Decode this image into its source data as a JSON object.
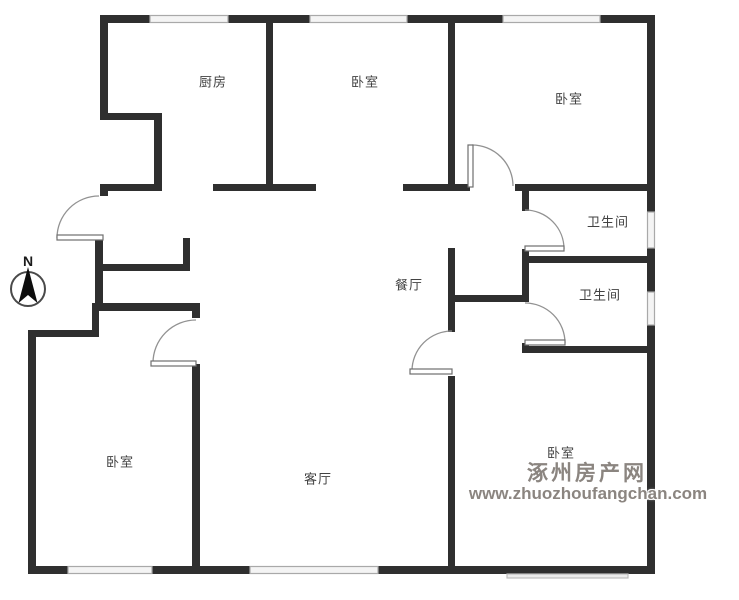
{
  "floorplan": {
    "rooms": [
      {
        "label": "厨房"
      },
      {
        "label": "卧室"
      },
      {
        "label": "卧室"
      },
      {
        "label": "卫生间"
      },
      {
        "label": "餐厅"
      },
      {
        "label": "卫生间"
      },
      {
        "label": "卧室"
      },
      {
        "label": "客厅"
      },
      {
        "label": "卧室"
      }
    ],
    "compass": {
      "label": "N"
    },
    "watermark": {
      "site_name": "涿州房产网",
      "url": "www.zhuozhoufangchan.com"
    },
    "colors": {
      "wall": "#2f2f2f",
      "window_fill": "#f4f4f4",
      "window_edge": "#a9a9a9",
      "door_arc": "#929292",
      "label": "#424242",
      "watermark": "#8b8580"
    }
  }
}
